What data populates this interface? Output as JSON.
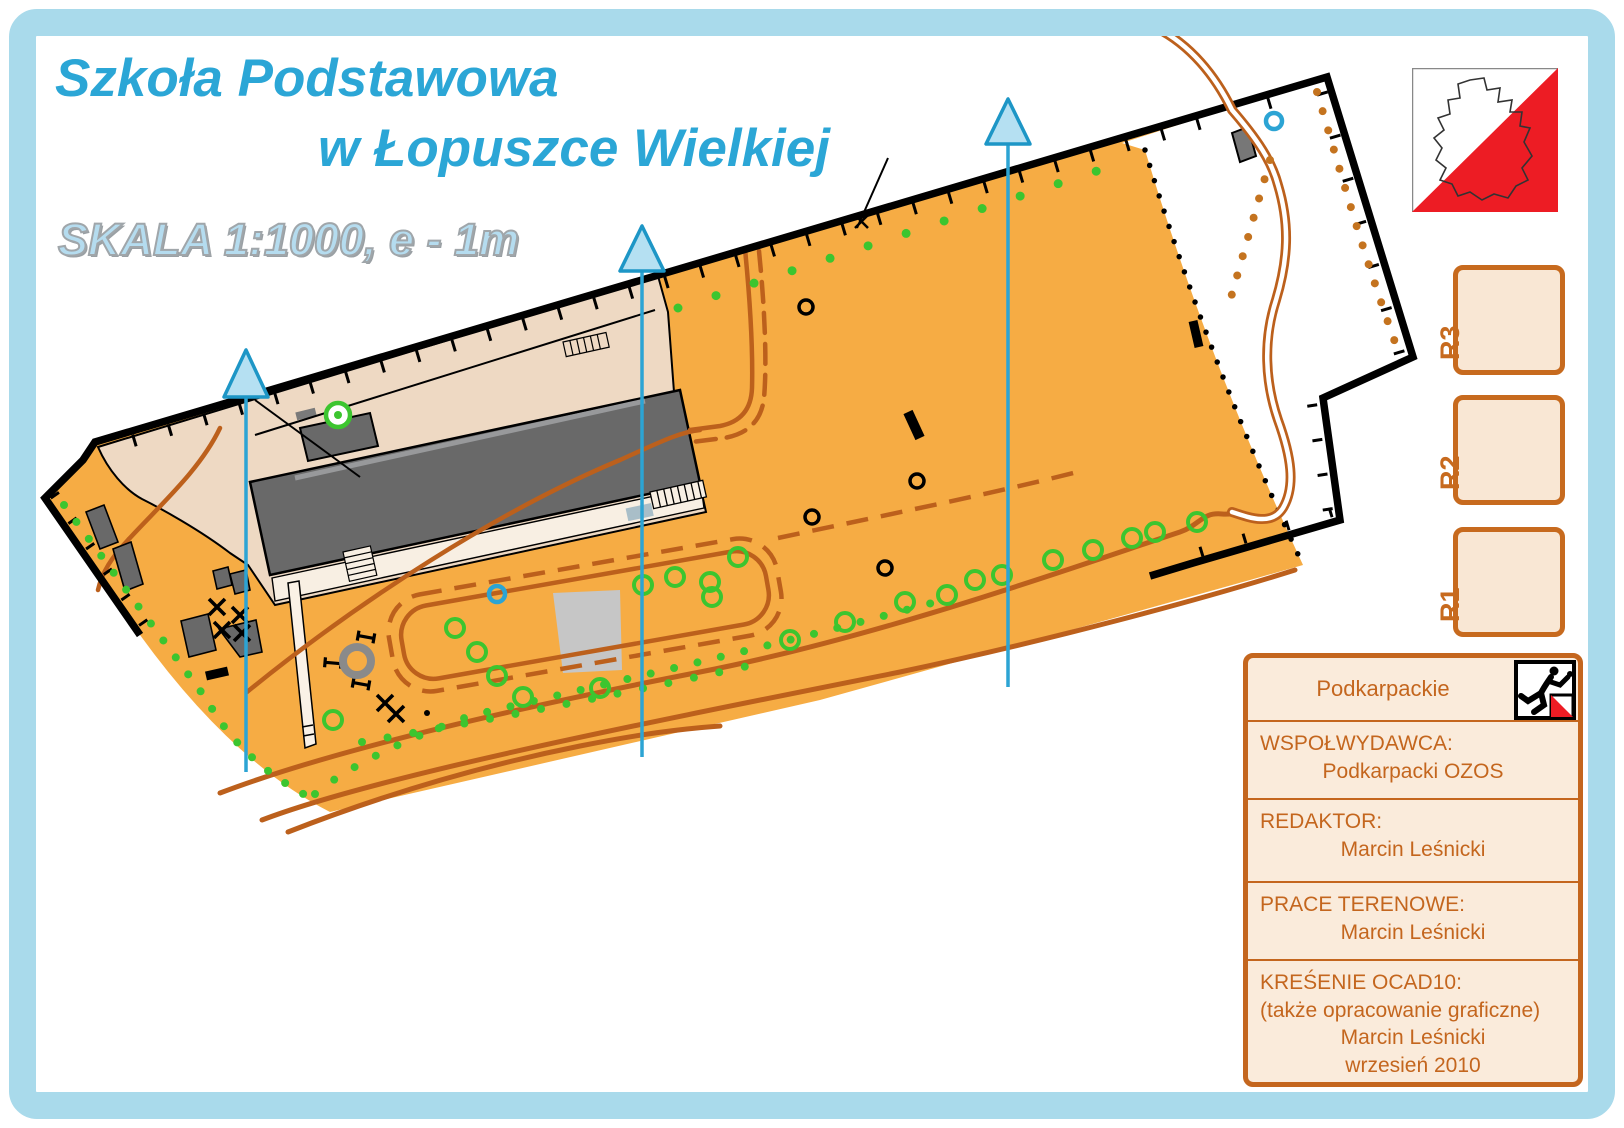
{
  "title": {
    "line1": "Szkoła Podstawowa",
    "line2": "w Łopuszce Wielkiej",
    "color": "#2BA6D6"
  },
  "scale_text": "SKALA 1:1000, e - 1m",
  "pozos_logo": {
    "text": "POZOS",
    "flag_red": "#ED1C24"
  },
  "refuge_boxes": [
    {
      "label": "R3"
    },
    {
      "label": "R2"
    },
    {
      "label": "R1"
    }
  ],
  "credits": {
    "region": "Podkarpackie",
    "accent_color": "#C4661E",
    "background": "#FAEBDB",
    "rows": [
      {
        "label": "WSPOŁWYDAWCA:",
        "value": "Podkarpacki OZOS"
      },
      {
        "label": "REDAKTOR:",
        "value": "Marcin Leśnicki"
      },
      {
        "label": "PRACE TERENOWE:",
        "value": "Marcin Leśnicki"
      },
      {
        "label": "KREŚENIE OCAD10:",
        "lines": [
          "(także opracowanie graficzne)",
          "Marcin Leśnicki",
          "wrzesień 2010"
        ]
      }
    ]
  },
  "map_colors": {
    "open_land_orange": "#F6AC44",
    "paved_area_tan": "#EED9C3",
    "building_gray": "#696969",
    "track_brown": "#BC601C",
    "vegetation_green": "#3CC52F",
    "water_blue": "#2CA4D4",
    "north_arrow_fill": "#B5E0F2",
    "frame_blue": "#A9DAEB"
  }
}
